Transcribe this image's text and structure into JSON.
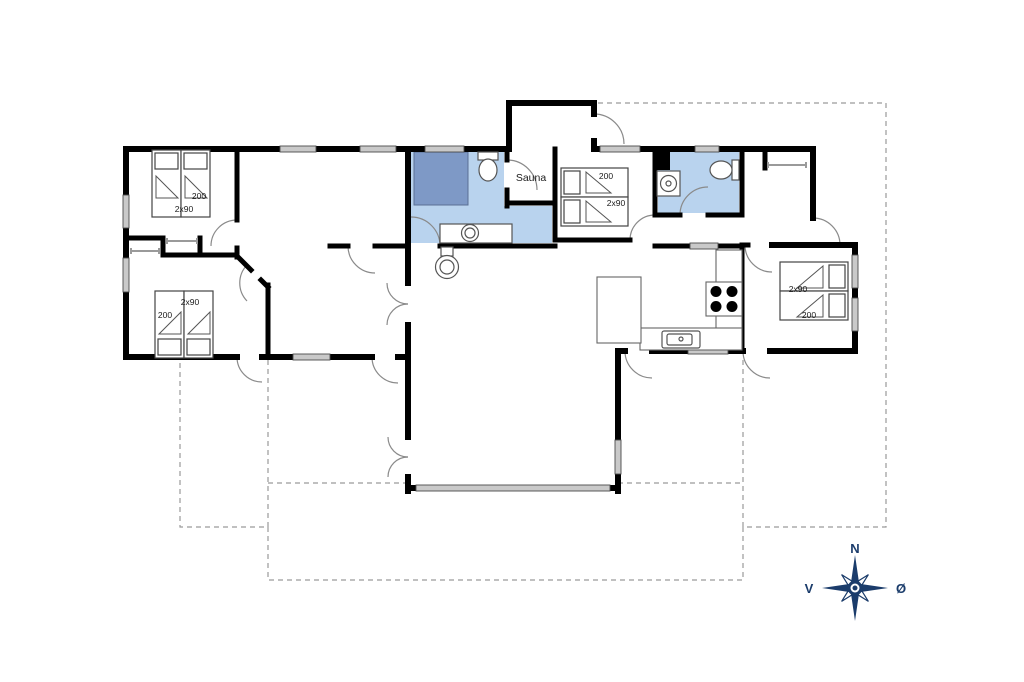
{
  "floorplan": {
    "colors": {
      "wall": "#000000",
      "window": "#c9c9c9",
      "bathroom_fill": "#b9d3ee",
      "shower_fill": "#7e99c6",
      "compass": "#1b3c6b",
      "terrace_dash": "#9a9a9a"
    },
    "rooms": {
      "sauna_label": "Sauna"
    },
    "bedrooms": {
      "top_left": {
        "length_label": "200",
        "width_label": "2x90"
      },
      "bottom_left": {
        "length_label": "200",
        "width_label": "2x90"
      },
      "middle": {
        "length_label": "200",
        "width_label": "2x90"
      },
      "right": {
        "length_label": "200",
        "width_label": "2x90"
      }
    },
    "compass": {
      "north": "N",
      "south": "S",
      "west": "V",
      "east": "Ø"
    }
  }
}
